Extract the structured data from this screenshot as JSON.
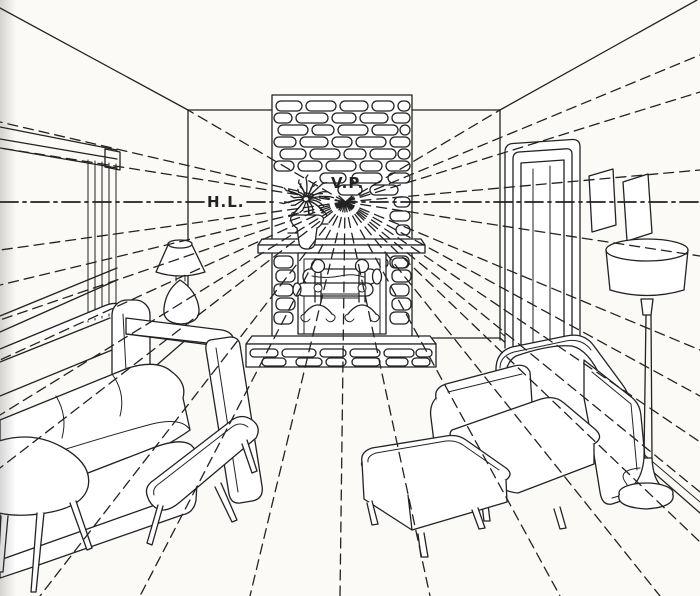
{
  "figure": {
    "horizon_label": "H.L.",
    "vanishing_point_label": "V.P."
  },
  "colors": {
    "ink": "#222222",
    "paper": "#fbfaf6"
  }
}
